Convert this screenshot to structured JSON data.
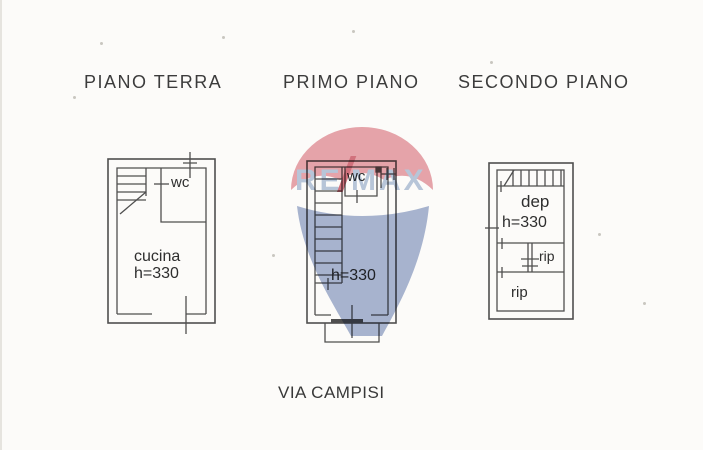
{
  "document": {
    "street": "VIA CAMPISI"
  },
  "floors": {
    "ground": {
      "title": "PIANO TERRA",
      "wc": "wc",
      "kitchen_label": "cucina",
      "height_label": "h=330"
    },
    "first": {
      "title": "PRIMO PIANO",
      "wc": "wc",
      "height_label": "h=330"
    },
    "second": {
      "title": "SECONDO PIANO",
      "storage_label": "dep",
      "height_label": "h=330",
      "closet1_label": "rip",
      "closet2_label": "rip"
    }
  },
  "watermark": {
    "brand_left": "RE",
    "brand_slash": "/",
    "brand_right": "MAX"
  },
  "colors": {
    "background": "#fcfbf9",
    "plan_line": "#4f4f4f",
    "label_text": "#2e2e2e",
    "watermark_red": "#e8a6ad",
    "watermark_slash_red": "#d4737f",
    "watermark_letter_blue": "#b9c8de",
    "watermark_balloon_blue": "#a9b6d3"
  }
}
